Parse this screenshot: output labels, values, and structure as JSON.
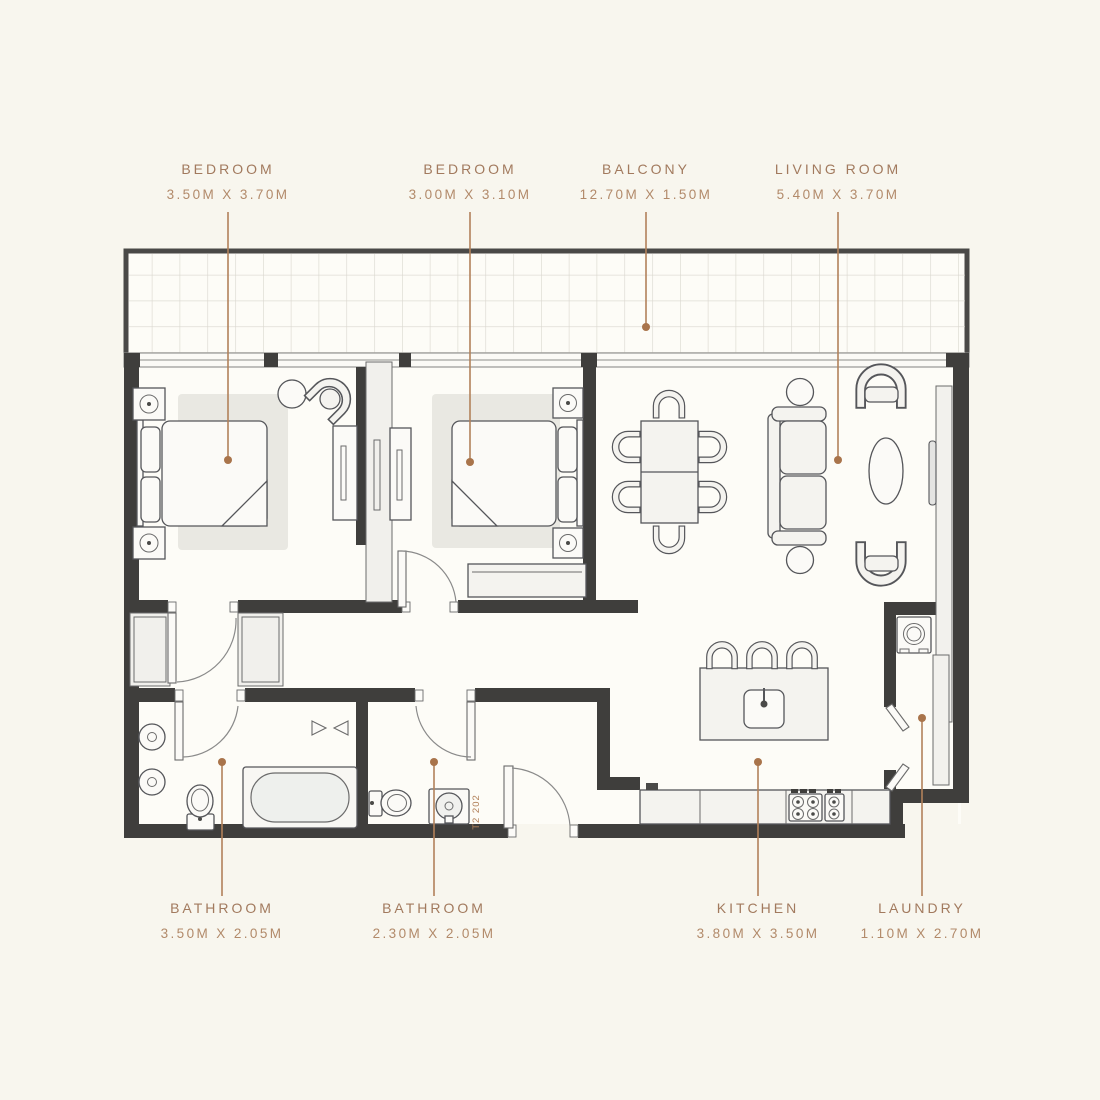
{
  "plan": {
    "unit_label": "T2 202",
    "labels": [
      {
        "name": "BEDROOM",
        "dims": "3.50M X 3.70M"
      },
      {
        "name": "BEDROOM",
        "dims": "3.00M X 3.10M"
      },
      {
        "name": "BALCONY",
        "dims": "12.70M X 1.50M"
      },
      {
        "name": "LIVING ROOM",
        "dims": "5.40M X 3.70M"
      },
      {
        "name": "BATHROOM",
        "dims": "3.50M X 2.05M"
      },
      {
        "name": "BATHROOM",
        "dims": "2.30M X 2.05M"
      },
      {
        "name": "KITCHEN",
        "dims": "3.80M X 3.50M"
      },
      {
        "name": "LAUNDRY",
        "dims": "1.10M X 2.70M"
      }
    ],
    "colors": {
      "background": "#f8f6ee",
      "wall": "#3f3e3c",
      "floor": "#fdfcf7",
      "furniture_fill": "#f4f3ef",
      "furniture_stroke": "#55565a",
      "label_text": "#a27a5e",
      "label_dims": "#b28a6a",
      "leader_line": "#b2815a",
      "leader_dot": "#a9744b",
      "tile_line": "#d9d6ce",
      "rug": "#e9e8e2"
    }
  }
}
